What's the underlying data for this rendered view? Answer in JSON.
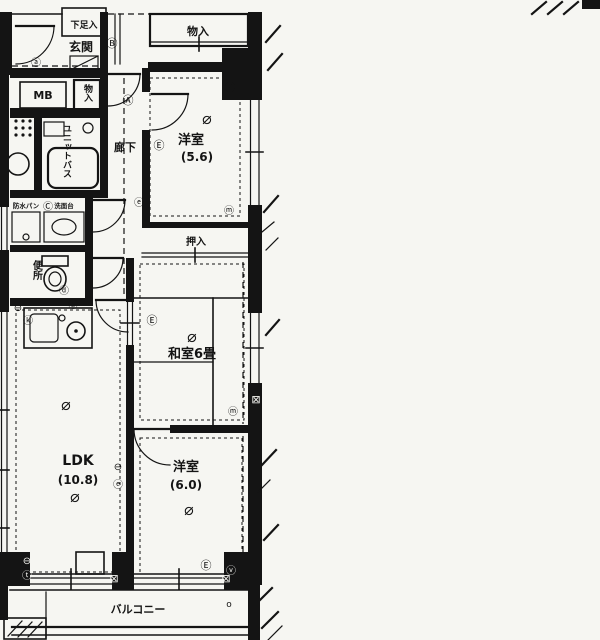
{
  "meta": {
    "kind": "apartment-floor-plan-scan",
    "ink_color": "#141414",
    "paper_color": "#f6f6f2"
  },
  "rooms": {
    "shoe_box": {
      "label": "下足入"
    },
    "genkan": {
      "label": "玄関"
    },
    "storage_top": {
      "label": "物入"
    },
    "meter_box": {
      "label": "MB"
    },
    "storage_small": {
      "label": "物入"
    },
    "unit_bath": {
      "label": "ユニットバス"
    },
    "corridor": {
      "label": "廊下"
    },
    "western_room_1": {
      "label": "洋室",
      "size": "(5.6)"
    },
    "oshiire": {
      "label": "押入"
    },
    "laundry_pan": {
      "label": "防水パン"
    },
    "washstand": {
      "label": "洗面台"
    },
    "toilet": {
      "label": "便所"
    },
    "japanese_room": {
      "label": "和室6畳"
    },
    "ldk": {
      "label": "LDK",
      "size": "(10.8)"
    },
    "western_room_2": {
      "label": "洋室",
      "size": "(6.0)"
    },
    "balcony": {
      "label": "バルコニー"
    }
  },
  "markers": [
    {
      "name": "switch-marker",
      "glyph": "ⓐ",
      "x": 36,
      "y": 66,
      "s": 10,
      "inv": false
    },
    {
      "name": "doorbell-marker",
      "glyph": "Ⓑ",
      "x": 112,
      "y": 47,
      "s": 11,
      "inv": false
    },
    {
      "name": "door-marker",
      "glyph": "Ⓐ",
      "x": 128,
      "y": 104,
      "s": 11,
      "inv": false
    },
    {
      "name": "outlet-marker",
      "glyph": "Ⓔ",
      "x": 230,
      "y": 91,
      "s": 11,
      "inv": false
    },
    {
      "name": "outlet-marker",
      "glyph": "Ⓔ",
      "x": 159,
      "y": 149,
      "s": 11,
      "inv": false
    },
    {
      "name": "outlet-marker",
      "glyph": "ⓔ",
      "x": 139,
      "y": 206,
      "s": 10,
      "inv": false
    },
    {
      "name": "outlet-marker",
      "glyph": "ⓜ",
      "x": 229,
      "y": 214,
      "s": 10,
      "inv": false
    },
    {
      "name": "outlet-marker",
      "glyph": "Ⓒ",
      "x": 48,
      "y": 210,
      "s": 10,
      "inv": false
    },
    {
      "name": "outlet-marker",
      "glyph": "ⓓ",
      "x": 64,
      "y": 294,
      "s": 10,
      "inv": false
    },
    {
      "name": "outlet-marker",
      "glyph": "⊖",
      "x": 18,
      "y": 311,
      "s": 10,
      "inv": false
    },
    {
      "name": "outlet-marker",
      "glyph": "ⓚ",
      "x": 28,
      "y": 324,
      "s": 10,
      "inv": false
    },
    {
      "name": "outlet-marker",
      "glyph": "ⓖ",
      "x": 73,
      "y": 308,
      "s": 10,
      "inv": false
    },
    {
      "name": "outlet-marker",
      "glyph": "Ⓔ",
      "x": 152,
      "y": 324,
      "s": 11,
      "inv": false
    },
    {
      "name": "outlet-marker",
      "glyph": "ⓜ",
      "x": 233,
      "y": 415,
      "s": 10,
      "inv": false
    },
    {
      "name": "outlet-marker",
      "glyph": "⊖",
      "x": 118,
      "y": 470,
      "s": 10,
      "inv": false
    },
    {
      "name": "outlet-marker",
      "glyph": "ⓔ",
      "x": 118,
      "y": 488,
      "s": 10,
      "inv": false
    },
    {
      "name": "outlet-marker",
      "glyph": "⊖",
      "x": 27,
      "y": 564,
      "s": 10,
      "inv": true
    },
    {
      "name": "outlet-marker",
      "glyph": "ⓣ",
      "x": 27,
      "y": 579,
      "s": 10,
      "inv": true
    },
    {
      "name": "outlet-marker",
      "glyph": "Ⓔ",
      "x": 206,
      "y": 569,
      "s": 11,
      "inv": false
    },
    {
      "name": "outlet-marker",
      "glyph": "ⓥ",
      "x": 231,
      "y": 574,
      "s": 10,
      "inv": true
    },
    {
      "name": "ceiling-light-symbol",
      "glyph": "⌀",
      "x": 207,
      "y": 124,
      "s": 16,
      "inv": false
    },
    {
      "name": "ceiling-light-symbol",
      "glyph": "⌀",
      "x": 192,
      "y": 342,
      "s": 16,
      "inv": false
    },
    {
      "name": "ceiling-light-symbol",
      "glyph": "⌀",
      "x": 66,
      "y": 410,
      "s": 16,
      "inv": false
    },
    {
      "name": "ceiling-light-symbol",
      "glyph": "⌀",
      "x": 75,
      "y": 502,
      "s": 16,
      "inv": false
    },
    {
      "name": "ceiling-light-symbol",
      "glyph": "⌀",
      "x": 189,
      "y": 515,
      "s": 16,
      "inv": false
    },
    {
      "name": "vent-marker",
      "glyph": "⊠",
      "x": 114,
      "y": 582,
      "s": 11,
      "inv": true
    },
    {
      "name": "vent-marker",
      "glyph": "⊠",
      "x": 226,
      "y": 582,
      "s": 11,
      "inv": true
    },
    {
      "name": "vent-marker",
      "glyph": "⊠",
      "x": 256,
      "y": 403,
      "s": 11,
      "inv": true
    },
    {
      "name": "drain-marker",
      "glyph": "o",
      "x": 229,
      "y": 607,
      "s": 9,
      "inv": false
    }
  ]
}
